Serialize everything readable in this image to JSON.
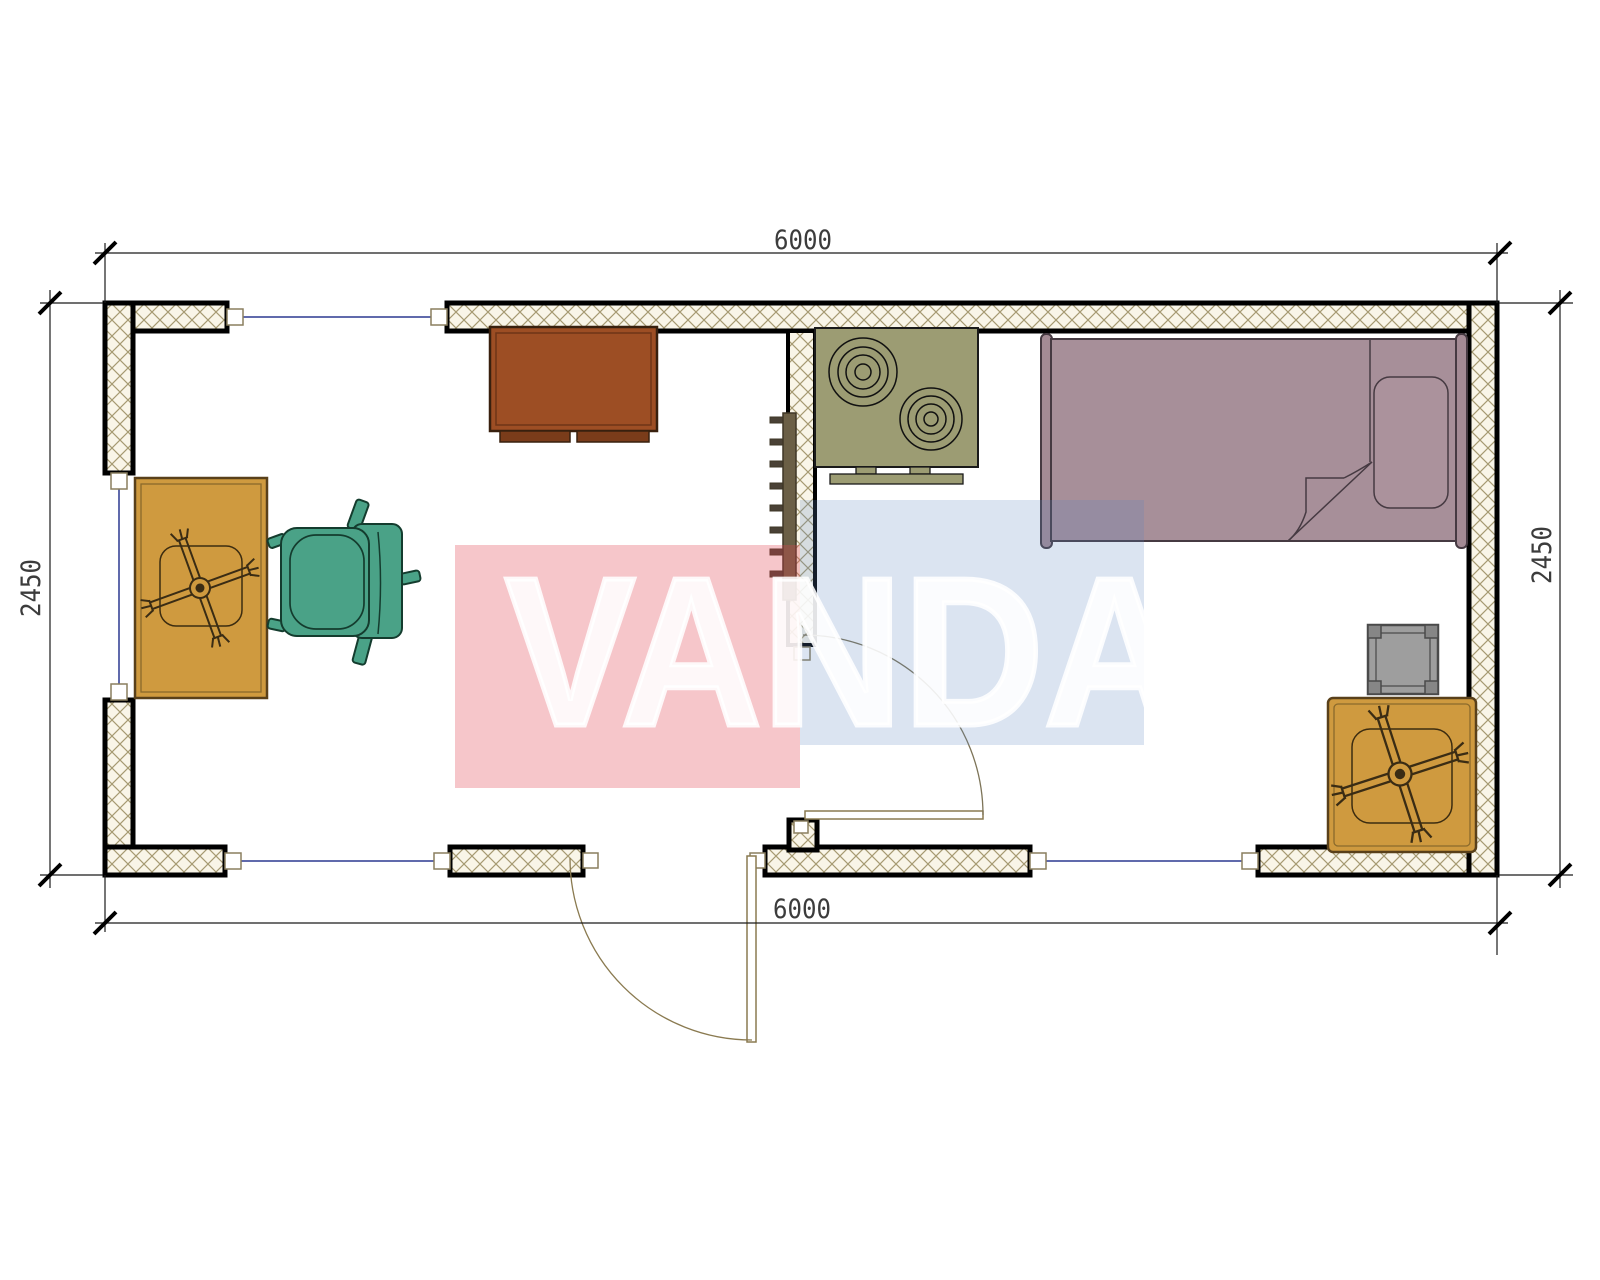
{
  "watermark": {
    "text": "VANDA",
    "red_color": "#e0414f",
    "blue_color": "#5b84c0",
    "text_color": "#ffffff"
  },
  "dimensions": {
    "top": "6000",
    "bottom": "6000",
    "left": "2450",
    "right": "2450"
  },
  "palette": {
    "wall_hatch_bg": "#f9f5e8",
    "wall_hatch_line": "#a69a72",
    "wall_border": "#000000",
    "window_glass": "#2b3990",
    "door_leaf": "#8a7a50",
    "cabinet": "#9d4e24",
    "cabinet_feet": "#7a3c1a",
    "stove": "#9c9c73",
    "bed": "#a78f99",
    "bed_post": "#a48b95",
    "pillow": "#ab929c",
    "bed_outline": "#463a42",
    "table": "#cf9a3f",
    "table_outline": "#59401a",
    "chair": "#4aa287",
    "chair_outline": "#143c2e",
    "side_table": "#9e9e9e",
    "side_table_post": "#868686",
    "radiator": "#6b5f46",
    "radiator_rung": "#4a4136",
    "dim_text": "#3c3c3c"
  },
  "furniture_symbols": [
    "tv-cabinet",
    "kitchen-stove",
    "single-bed",
    "desk-with-ceiling-fan",
    "office-chair",
    "side-table",
    "coffee-table-with-ceiling-fan",
    "wall-radiator",
    "entry-door",
    "interior-door",
    "window"
  ]
}
